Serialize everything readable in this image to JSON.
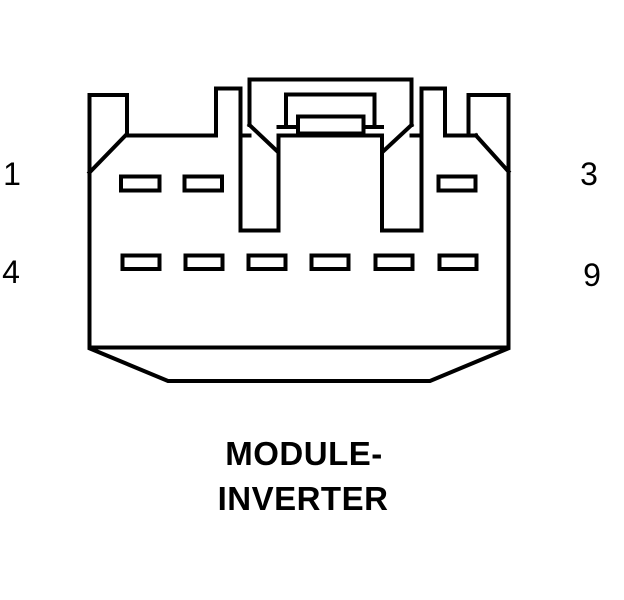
{
  "diagram": {
    "type": "connector-pinout",
    "line_color": "#000000",
    "background_color": "#ffffff",
    "caption": {
      "line1": "MODULE-",
      "line2": "INVERTER"
    },
    "pin_rows": [
      {
        "left_label": "1",
        "right_label": "3",
        "visible_cavities": 3
      },
      {
        "left_label": "4",
        "right_label": "9",
        "visible_cavities": 6
      }
    ]
  }
}
